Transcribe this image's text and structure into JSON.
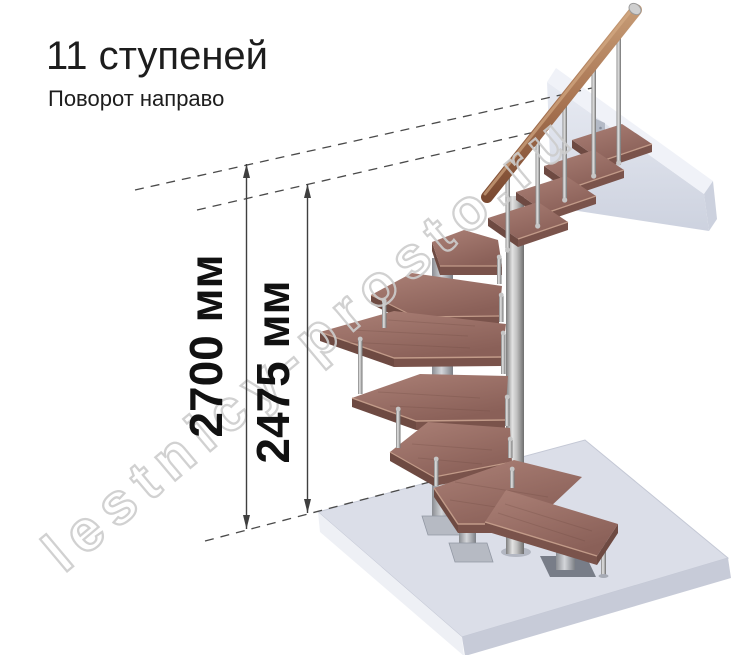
{
  "page": {
    "background": "#ffffff",
    "width": 743,
    "height": 655
  },
  "header": {
    "title": "11 ступеней",
    "subtitle": "Поворот направо"
  },
  "dimensions": [
    {
      "id": "total-height",
      "label": "2700 мм"
    },
    {
      "id": "height-to-top-step",
      "label": "2475 мм"
    }
  ],
  "watermark": {
    "text": "lestnicy-prosto.ru"
  },
  "figure": {
    "type": "3d-render-modular-spiral-staircase",
    "steps_count": 11,
    "turn_direction": "направо",
    "colors": {
      "tread_wood_top": "#9c7268",
      "tread_wood_edge": "#7a534b",
      "handrail_wood": "#a87452",
      "metal": "#b9b9b9",
      "floor_slab": "#dbdee8",
      "landing_beam": "#e4e7f0",
      "dimension_lines": "#3f3f3f",
      "watermark": "#cdcdcd"
    }
  }
}
